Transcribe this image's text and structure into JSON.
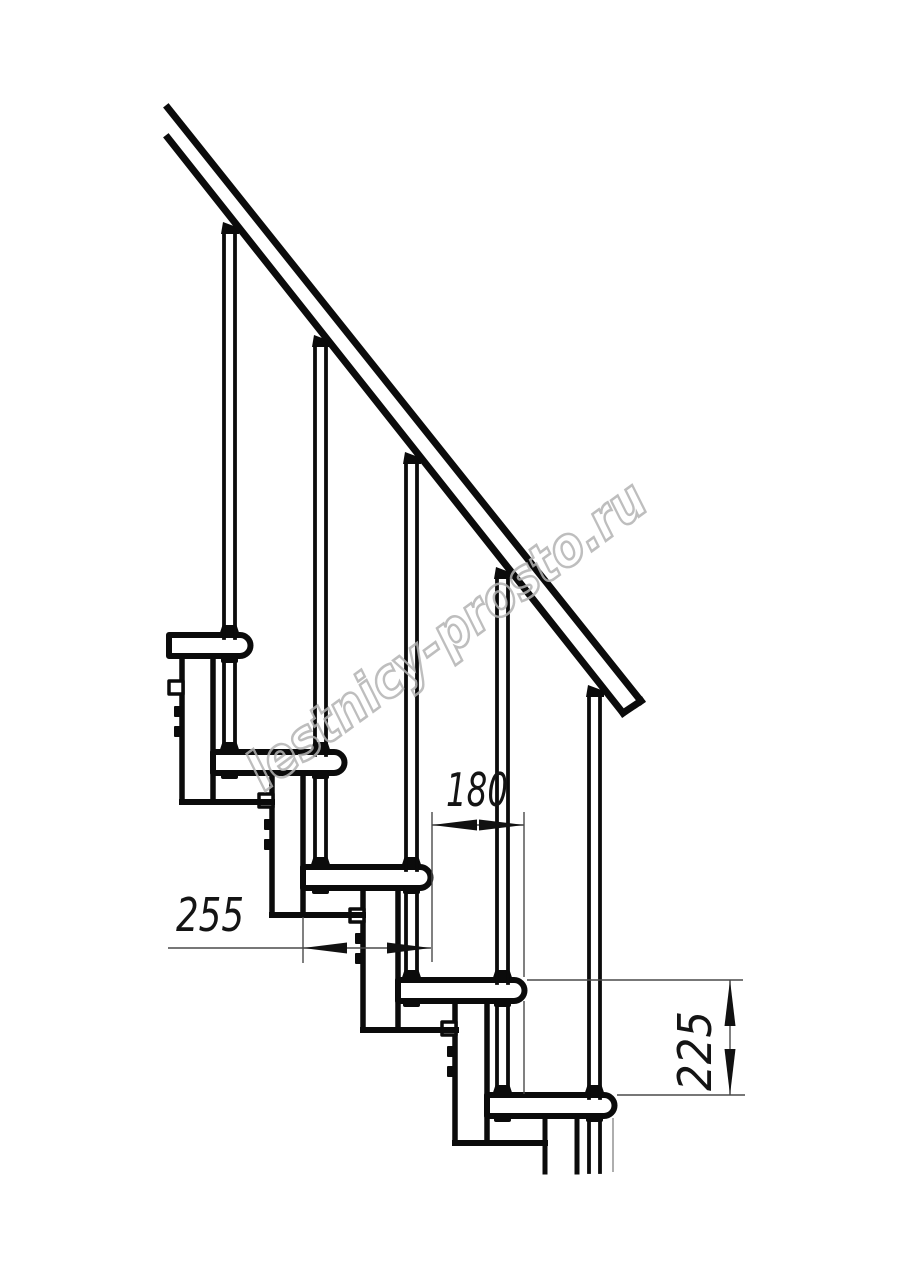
{
  "drawing": {
    "title": "Modular staircase side-view technical drawing",
    "background_color": "#ffffff",
    "line_color": "#0b0b0b",
    "dimension_color": "#4a4a4a",
    "watermark": {
      "text": "lestnicy-prosto.ru",
      "color": "#b3b3b3"
    },
    "dimensions": {
      "tread_depth": {
        "value": "255",
        "orientation": "horizontal"
      },
      "step_run": {
        "value": "180",
        "orientation": "horizontal"
      },
      "step_rise": {
        "value": "225",
        "orientation": "vertical"
      }
    },
    "parts": {
      "handrail_count": 1,
      "baluster_count": 5,
      "tread_count": 5,
      "support_column_count": 5
    }
  }
}
